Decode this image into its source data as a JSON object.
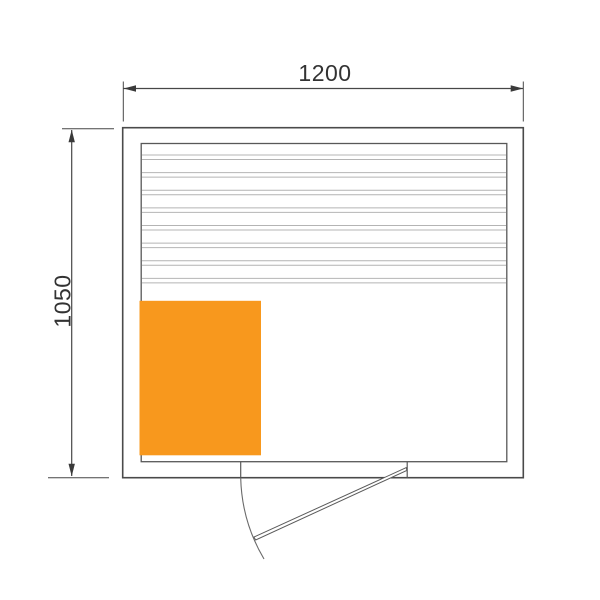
{
  "drawing": {
    "type": "sauna-floor-plan",
    "dimensions": {
      "width_label": "1200",
      "height_label": "1050"
    },
    "colors": {
      "heater_fill": "#F8981D",
      "wall_line": "#4a4a4a",
      "slat_line": "#b4b4b4",
      "dimension_text": "#333333"
    },
    "bench": {
      "slat_pairs": 8
    }
  }
}
